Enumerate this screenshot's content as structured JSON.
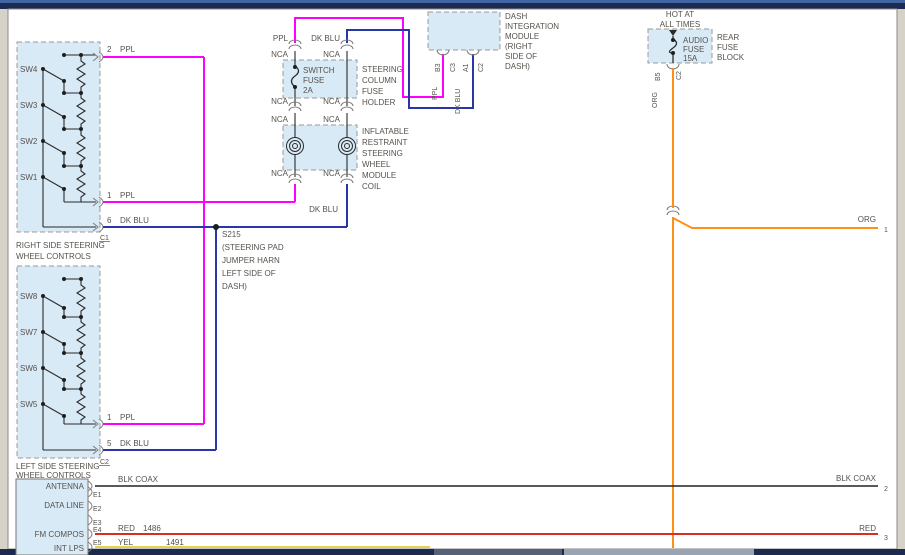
{
  "diagram": {
    "wire_colors": {
      "ppl": "#ff00ff",
      "dk_blu": "#2936a5",
      "org": "#ff9015",
      "red": "#da2c20",
      "yel": "#e3d24f",
      "blk_coax": "#222222"
    },
    "labels": {
      "ppl": "PPL",
      "dk_blu": "DK BLU",
      "nca": "NCA",
      "org": "ORG",
      "blk_coax": "BLK COAX",
      "red": "RED",
      "yel": "YEL"
    },
    "right_controls": {
      "caption": [
        "RIGHT SIDE STEERING",
        "WHEEL CONTROLS"
      ],
      "switches": [
        "SW4",
        "SW3",
        "SW2",
        "SW1"
      ],
      "pins": [
        "2",
        "1",
        "6"
      ],
      "connector": "C1"
    },
    "left_controls": {
      "caption": [
        "LEFT SIDE STEERING",
        "WHEEL CONTROLS"
      ],
      "switches": [
        "SW8",
        "SW7",
        "SW6",
        "SW5"
      ],
      "pins": [
        "1",
        "5"
      ],
      "connector": "C2"
    },
    "fuse_holder": {
      "name": [
        "SWITCH",
        "FUSE",
        "2A"
      ],
      "caption": [
        "STEERING",
        "COLUMN",
        "FUSE",
        "HOLDER"
      ]
    },
    "coil": {
      "caption": [
        "INFLATABLE",
        "RESTRAINT",
        "STEERING",
        "WHEEL",
        "MODULE",
        "COIL"
      ]
    },
    "dim": {
      "caption": [
        "DASH",
        "INTEGRATION",
        "MODULE",
        "(RIGHT",
        "SIDE OF",
        "DASH)"
      ],
      "pins": [
        "B3",
        "C3",
        "A1",
        "C2"
      ]
    },
    "rear_fuse": {
      "power": [
        "HOT AT",
        "ALL TIMES"
      ],
      "name": [
        "AUDIO",
        "FUSE",
        "15A"
      ],
      "caption": [
        "REAR",
        "FUSE",
        "BLOCK"
      ],
      "pins": [
        "B5",
        "C2"
      ]
    },
    "splice": {
      "id": "S215",
      "caption": [
        "(STEERING PAD",
        "JUMPER HARN",
        "LEFT SIDE OF",
        "DASH)"
      ]
    },
    "radio": {
      "rows": [
        "ANTENNA",
        "DATA LINE",
        "FM COMPOS",
        "INT LPS"
      ],
      "pins": [
        "E1",
        "E2",
        "E3",
        "E4",
        "E5"
      ],
      "circuits": {
        "red": "1486",
        "yel": "1491"
      }
    },
    "terminals": [
      "1",
      "2",
      "3"
    ]
  }
}
